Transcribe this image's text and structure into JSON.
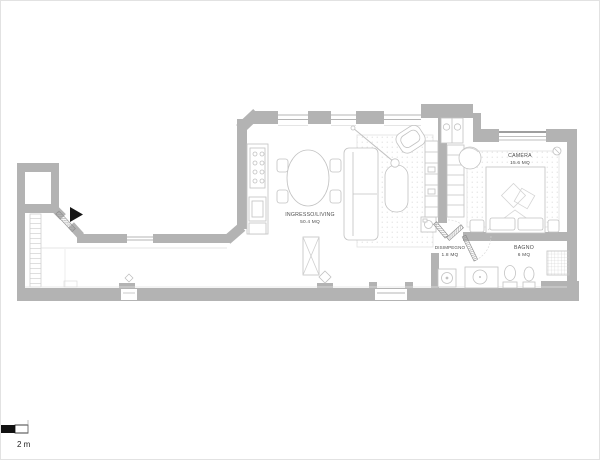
{
  "plan": {
    "rooms": [
      {
        "name": "INGRESSO/LIVING",
        "area": "50.4 MQ"
      },
      {
        "name": "CAMERA",
        "area": "15.6 MQ"
      },
      {
        "name": "DISIMPEGNO",
        "area": "1.8 MQ"
      },
      {
        "name": "BAGNO",
        "area": "6 MQ"
      }
    ],
    "scale_label": "2 m",
    "colors": {
      "wall": "#b3b3b3",
      "furniture_outline": "#c2c2c2",
      "rug_fill": "#f4f4f4",
      "label_text": "#4d4d4d",
      "entry_arrow": "#161616",
      "background": "#ffffff"
    }
  }
}
